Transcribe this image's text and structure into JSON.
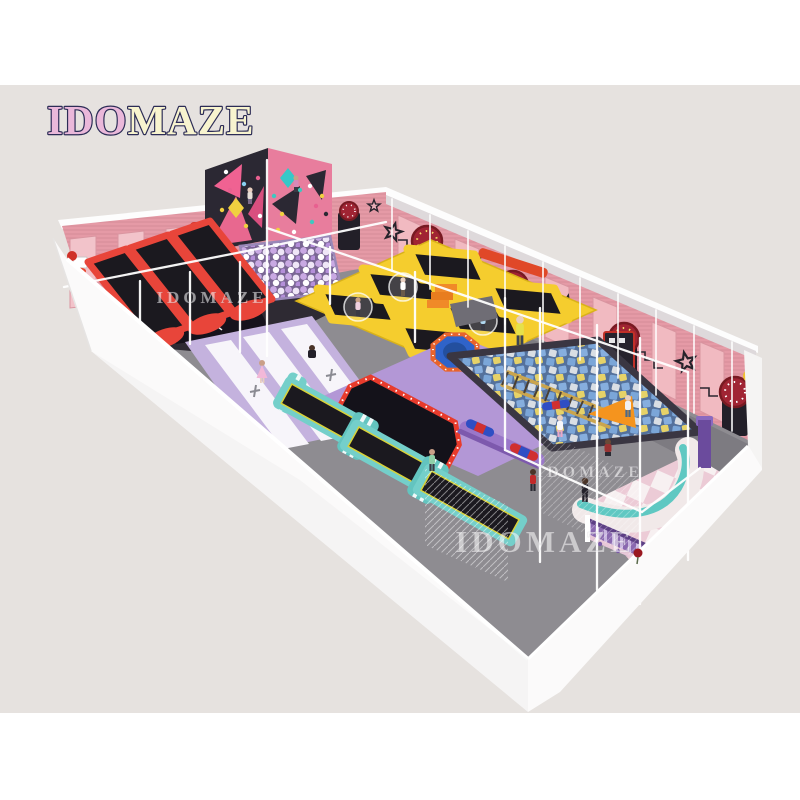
{
  "page": {
    "width": 800,
    "height": 800
  },
  "logo": {
    "text": "IDOMAZE",
    "segment_pink": "IDO",
    "segment_yellow": "MAZE"
  },
  "watermarks": [
    {
      "text": "IDOMAZE"
    },
    {
      "text": "IDOMAZE"
    },
    {
      "text": "IDOMAZE"
    }
  ],
  "palette": {
    "white": "#ffffff",
    "canvas": "#e6e2df",
    "logo_pink": "#eab8da",
    "logo_yellow": "#f8f4cf",
    "logo_outline": "#2c2c56",
    "wall_pink": "#e59aa6",
    "wall_panel": "#f1bac1",
    "wall_dark": "#2b2833",
    "climb_pink": "#e87d9d",
    "mat_black": "#1b191f",
    "frame_red": "#e8453a",
    "frame_yellow": "#f5cd2e",
    "floor_gray": "#8e8c91",
    "floor_purple": "#b397d6",
    "floor_lavender": "#c4b2de",
    "lane_teal": "#74cfca",
    "bench_teal": "#5fc8c2",
    "foam_blue": "#7ba6d8",
    "foam_yellow": "#e6d268",
    "ball_lavender": "#c9a9e3",
    "arch_red": "#a02433",
    "fence_purple": "#8a68b0",
    "orange": "#f08a28",
    "blue_trampoline": "#2f63c9"
  }
}
